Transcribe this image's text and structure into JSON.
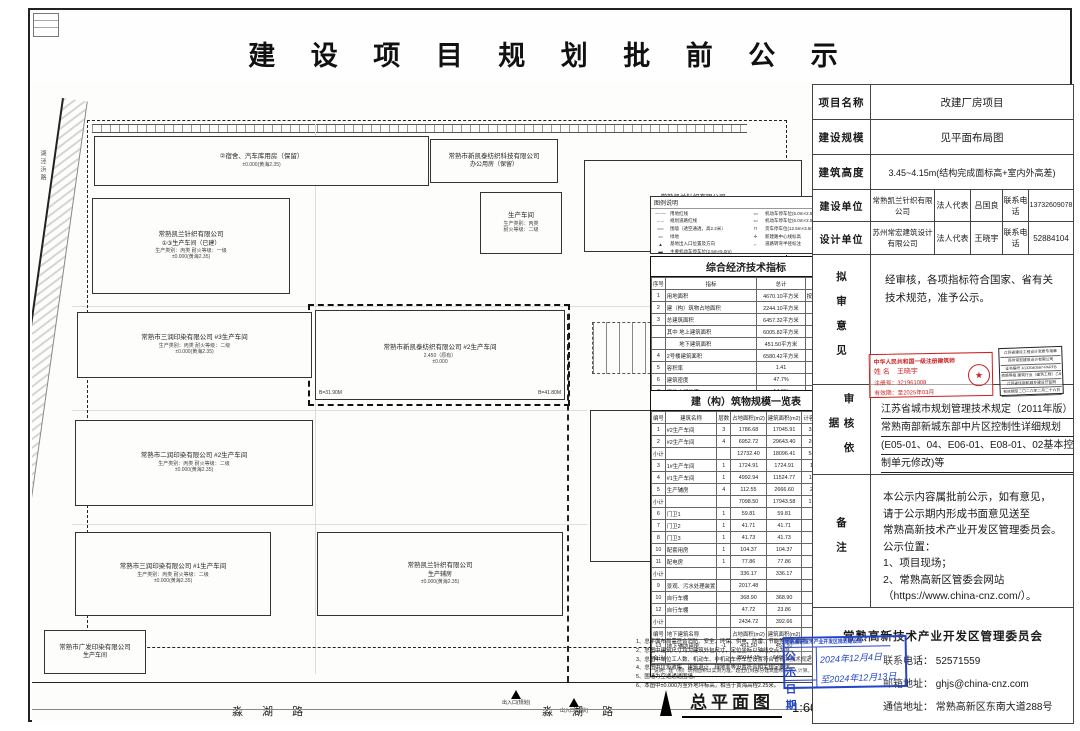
{
  "title": "建 设 项 目 规 划 批 前 公 示",
  "panel": {
    "rows": {
      "project_label": "项目名称",
      "project_value": "改建厂房项目",
      "scale_label": "建设规模",
      "scale_value": "见平面布局图",
      "height_label": "建筑高度",
      "height_value": "3.45~4.15m(结构完成面标高+室内外高差)",
      "builder_label": "建设单位",
      "builder_name": "常熟凯兰针织有限公司",
      "builder_rep_label": "法人代表",
      "builder_rep": "吕国良",
      "builder_tel_label": "联系电话",
      "builder_tel": "13732609078",
      "designer_label": "设计单位",
      "designer_name": "苏州常宏建筑设计有限公司",
      "designer_rep_label": "法人代表",
      "designer_rep": "王晓宇",
      "designer_tel_label": "联系电话",
      "designer_tel": "52884104",
      "opinion_label": "拟审意见",
      "opinion_text": "经审核，各项指标符合国家、省有关技术规范，准予公示。",
      "basis_label": "审核依据",
      "remark_label": "备注"
    },
    "basis_lines": [
      "江苏省城市规划管理技术规定（2011年版）",
      "常熟南部新城东部中片区控制性详细规划",
      "(E05-01、04、E06-01、E08-01、02基本控",
      "制单元修改)等"
    ],
    "remark_lines": [
      "本公示内容属批前公示，如有意见，",
      "请于公示期内形成书面意见送至",
      "常熟高新技术产业开发区管理委员会。",
      "公示位置：",
      "1、项目现场；",
      "2、常熟高新区管委会网站",
      "（https://www.china-cnz.com/）。"
    ],
    "red_stamp": {
      "l1": "中华人民共和国一级注册建筑师",
      "l2": "姓 名　王晓宇",
      "l3": "注册号：321961008",
      "l4": "有效期：至2025年03月",
      "seal": "★"
    },
    "black_stamp_lines": [
      "江苏省建设工程设计资质专用章",
      "苏州常宏建筑设计有限公司",
      "证书编号 A132040597-PARFB",
      "资质等级 建筑行业（建筑工程）乙级",
      "江苏省住房和城乡建设厅监制",
      "有效期至二〇二六年二月二十六日"
    ],
    "footer": {
      "org": "常熟高新技术产业开发区管理委员会",
      "tel_label": "联系电话：",
      "tel": "52571559",
      "email_label": "邮箱地址：",
      "email": "ghjs@china-cnz.com",
      "addr_label": "通信地址：",
      "addr": "常熟高新区东南大道288号"
    },
    "blue_stamp": {
      "header": "常熟高新技术产业开发区规划建设局",
      "r1_label": "公 示",
      "r1_value": "2024年12月4日",
      "r2_label": "日 期",
      "r2_value": "至2024年12月13日"
    }
  },
  "plan": {
    "side_road": "湖泾浜路",
    "road_labels": [
      "淼 湖 路",
      "淼 湖 路"
    ],
    "buildings": [
      {
        "x": 62,
        "y": 52,
        "w": 335,
        "h": 50,
        "l1": "②宿舍、汽车库用房（保留）",
        "s1": "±0.000(黄海2.35)"
      },
      {
        "x": 398,
        "y": 55,
        "w": 128,
        "h": 44,
        "l1": "常熟市新凯泰纺织科技有限公司",
        "l2": "办公用房（保留）"
      },
      {
        "x": 448,
        "y": 108,
        "w": 82,
        "h": 62,
        "l1": "生产车间",
        "s1": "生产类别：丙类",
        "s2": "耐火等级：二级"
      },
      {
        "x": 552,
        "y": 76,
        "w": 218,
        "h": 92,
        "l1": "常熟凯兰针织有限公司",
        "l2": "2#厂房（已建）",
        "s1": "生产类别：丙类  耐火等级：二级"
      },
      {
        "x": 60,
        "y": 114,
        "w": 198,
        "h": 96,
        "l1": "常熟凯兰针织有限公司",
        "l2": "①③生产车间（已建）",
        "s1": "生产类别：丙类  耐火等级：一级",
        "s2": "±0.000(黄海2.35)"
      },
      {
        "x": 283,
        "y": 226,
        "w": 250,
        "h": 90,
        "l1": "常熟市新凯泰纺织有限公司  #2生产车间",
        "s1": "2.450（原有）",
        "s2": "±0.000",
        "c1": "B=31.90M",
        "c2": "B=41.80M"
      },
      {
        "x": 45,
        "y": 228,
        "w": 235,
        "h": 66,
        "l1": "常熟市三润印染有限公司  #3生产车间",
        "s1": "生产类别：丙类  耐火等级：二级",
        "s2": "±0.000(黄海2.35)"
      },
      {
        "x": 43,
        "y": 336,
        "w": 238,
        "h": 86,
        "l1": "常熟市二润印染有限公司  #2生产车间",
        "s1": "生产类别：丙类  耐火等级：二级",
        "s2": "±0.000(黄海2.35)"
      },
      {
        "x": 43,
        "y": 448,
        "w": 196,
        "h": 84,
        "l1": "常熟市三润印染有限公司  #1生产车间",
        "s1": "生产类别：丙类  耐火等级：二级",
        "s2": "±0.000(黄海2.35)"
      },
      {
        "x": 558,
        "y": 326,
        "w": 212,
        "h": 152,
        "l1": "常熟凯兰针织有限公司",
        "l2": "①②生产车间",
        "s2": "±0.000(黄海2.35)"
      },
      {
        "x": 285,
        "y": 448,
        "w": 246,
        "h": 84,
        "l1": "常熟凯兰针织有限公司",
        "l2": "生产辅房",
        "s2": "±0.000(黄海2.35)"
      },
      {
        "x": 12,
        "y": 546,
        "w": 102,
        "h": 44,
        "l1": "常熟市广发印染有限公司",
        "l2": "生产车间"
      }
    ],
    "dims": [
      {
        "t": "6.23",
        "x": 192,
        "y": 22,
        "rot": 90
      },
      {
        "t": "7.0",
        "x": 196,
        "y": 62,
        "rot": 90
      },
      {
        "t": "12.23",
        "x": 206,
        "y": 92,
        "rot": 90
      },
      {
        "t": "7.49",
        "x": 218,
        "y": 72,
        "rot": 90
      },
      {
        "t": "6.16",
        "x": 228,
        "y": 40,
        "rot": 90
      },
      {
        "t": "6.30",
        "x": 244,
        "y": 96
      },
      {
        "t": "12.0",
        "x": 296,
        "y": 58,
        "rot": 90
      },
      {
        "t": "26.10",
        "x": 268,
        "y": 168
      },
      {
        "t": "13.42",
        "x": 536,
        "y": 217
      },
      {
        "t": "11.44",
        "x": 40,
        "y": 126
      },
      {
        "t": "-3.62",
        "x": 10,
        "y": 162
      },
      {
        "t": "5.0",
        "x": 26,
        "y": 318,
        "cls": "big"
      },
      {
        "t": "13.70",
        "x": 352,
        "y": 318,
        "rot": 90
      },
      {
        "t": "15.0",
        "x": 372,
        "y": 575,
        "rot": 90
      },
      {
        "t": "8.0",
        "x": 360,
        "y": 577,
        "rot": 90
      },
      {
        "t": "41.60",
        "x": 288,
        "y": 560
      },
      {
        "t": "砼4",
        "x": 566,
        "y": 152
      },
      {
        "t": "混5",
        "x": 528,
        "y": 203
      },
      {
        "t": "混4",
        "x": 16,
        "y": 538
      },
      {
        "t": "周边红线",
        "x": 250,
        "y": 300
      },
      {
        "t": "未变更",
        "x": 253,
        "y": 309
      },
      {
        "t": "车间之间干道间隔",
        "x": 462,
        "y": 290
      }
    ],
    "elevations": [
      {
        "t": "1.42",
        "x": 100,
        "y": 630
      },
      {
        "t": "2.17",
        "x": 195,
        "y": 600
      },
      {
        "t": "2.32",
        "x": 448,
        "y": 600
      },
      {
        "t": "2.07",
        "x": 400,
        "y": 630
      },
      {
        "t": "2.08",
        "x": 590,
        "y": 630
      },
      {
        "t": "2.10",
        "x": 735,
        "y": 630
      }
    ],
    "entrances": [
      {
        "t": "出入口(规划)",
        "x": 470,
        "y": 606
      },
      {
        "t": "出入口(现状)",
        "x": 528,
        "y": 614
      }
    ],
    "legend": {
      "title": "图例说明",
      "left": [
        {
          "sym": "—·—",
          "label": "用地红线"
        },
        {
          "sym": "– –",
          "label": "规划道路红线"
        },
        {
          "sym": "══",
          "label": "围墙（透空通透，高2.2米）"
        },
        {
          "sym": "▭",
          "label": "绿地"
        },
        {
          "sym": "▲",
          "label": "基地出入口位置及方向"
        },
        {
          "sym": "▬",
          "label": "主要机动车停车位(2.5m×5.0m)"
        }
      ],
      "right": [
        {
          "sym": "▭",
          "label": "机动车停车位(5.0m×2.5m)垂直式"
        },
        {
          "sym": "▭",
          "label": "机动车停车位(6.0m×2.5m)平行式"
        },
        {
          "sym": "⊓",
          "label": "货车停车位(12.5m×3.5m)"
        },
        {
          "sym": "✛",
          "label": "新建路中心线标高"
        },
        {
          "sym": "⌐",
          "label": "道路转弯半径标注"
        }
      ]
    },
    "eco_table": {
      "title": "综合经济技术指标",
      "headers": [
        "序号",
        "指标",
        "总计",
        "备注"
      ],
      "rows": [
        {
          "no": "1",
          "name": "用地面积",
          "val": "4670.10平方米",
          "rem": "按地形图计算"
        },
        {
          "no": "2",
          "name": "建（构）筑物占地面积",
          "val": "2244.10平方米",
          "rem": ""
        },
        {
          "no": "3",
          "name": "总建筑面积",
          "val": "6457.32平方米",
          "rem": ""
        },
        {
          "no": "",
          "name": "其中 地上建筑面积",
          "val": "6005.82平方米",
          "rem": ""
        },
        {
          "no": "",
          "name": "　　 地下建筑面积",
          "val": "451.50平方米",
          "rem": ""
        },
        {
          "no": "4",
          "name": "2号楼建筑面积",
          "val": "6580.42平方米",
          "rem": ""
        },
        {
          "no": "5",
          "name": "容积率",
          "val": "1.41",
          "rem": ""
        },
        {
          "no": "6",
          "name": "建筑密度",
          "val": "47.7%",
          "rem": ""
        },
        {
          "no": "7",
          "name": "用地内绿地率",
          "val": "14.6%",
          "rem": ""
        },
        {
          "no": "8",
          "name": "机动车停车位（每1.15辆/百平方米）",
          "val": "58个",
          "rem": ""
        },
        {
          "no": "9",
          "name": "非机动车停车位（按0.4辆/每工）",
          "val": "84个",
          "rem": ""
        }
      ],
      "note": "说明：带*指标为本次（改建）报批范围内数值，停车位按规定结合现状统一计算。"
    },
    "bld_table": {
      "title": "建（构）筑物规模一览表",
      "headers": [
        "编号",
        "建筑名称",
        "层数",
        "占地面积(m2)",
        "建筑面积(m2)",
        "计容面积(m2)",
        "备注"
      ],
      "rows": [
        [
          "1",
          "#2生产车间",
          "3",
          "1786.68",
          "17045.91",
          "33296.98",
          "已建"
        ],
        [
          "2",
          "#2生产车间",
          "4",
          "6952.72",
          "29643.40",
          "26957.97",
          "已建"
        ],
        [
          "小计",
          "",
          "",
          "12732.40",
          "18096.41",
          "54314.87",
          ""
        ],
        [
          "3",
          "1#生产车间",
          "1",
          "1724.91",
          "1724.91",
          "1724.91",
          ""
        ],
        [
          "4",
          "#1生产车间",
          "1",
          "4992.94",
          "11524.77",
          "11524.77",
          "已在产权"
        ],
        [
          "5",
          "生产辅房",
          "4",
          "112.55",
          "2666.60",
          "2699.90",
          ""
        ],
        [
          "小计",
          "",
          "",
          "7098.50",
          "17943.58",
          "17947.98",
          ""
        ],
        [
          "6",
          "门卫1",
          "1",
          "59.81",
          "59.81",
          "59.81",
          ""
        ],
        [
          "7",
          "门卫2",
          "1",
          "41.71",
          "41.71",
          "41.71",
          ""
        ],
        [
          "8",
          "门卫3",
          "1",
          "41.73",
          "41.73",
          "41.73",
          "变动不批"
        ],
        [
          "10",
          "配套用房",
          "1",
          "104.37",
          "104.37",
          "104.37",
          ""
        ],
        [
          "11",
          "配电房",
          "1",
          "77.86",
          "77.86",
          "77.86",
          ""
        ],
        [
          "小计",
          "",
          "",
          "336.17",
          "336.17",
          "336.17",
          ""
        ],
        [
          "9",
          "景观、污水处理装置",
          "",
          "2017.48",
          "",
          "",
          ""
        ],
        [
          "10",
          "自行车棚",
          "",
          "368.90",
          "368.90",
          "",
          "拟保留、雨棚等"
        ],
        [
          "12",
          "自行车棚",
          "",
          "47.72",
          "23.86",
          "",
          ""
        ],
        [
          "小计",
          "",
          "",
          "2434.72",
          "392.66",
          "－",
          ""
        ],
        [
          "编号",
          "地下建筑名称",
          "",
          "占地面积(m2)",
          "建筑面积(m2)",
          "",
          ""
        ],
        [
          "13",
          "地下辅助用房",
          "-1",
          "451.50",
          "451.50",
          "",
          "已建"
        ],
        [
          "合计",
          "",
          "",
          "25044.15",
          "64087.30",
          "68398.62",
          ""
        ]
      ],
      "note": "说明：建（构）筑物面积以实测为准，超出红线部分建筑面积未纳入计算。"
    },
    "notes": [
      "1、总平面布局需符合消防、安全、环保、供电、防雷、节能等相关要求。",
      "2、总图中建筑尺寸均为建筑外包尺寸，定位坐标以轴线交点为准。",
      "3、总图中单位工人数、机动车、非机动车停车位设置符合省有关技术规定。",
      "4、总图中垃圾收集、建筑退让、绿地率等设置符合相关规定要求。",
      "5、围墙为空透通透围墙。",
      "6、本图中±0.000为室外地坪标高，相当于黄海高程2.25米。"
    ],
    "caption": {
      "name": "总平面图",
      "scale": "1:600"
    }
  }
}
